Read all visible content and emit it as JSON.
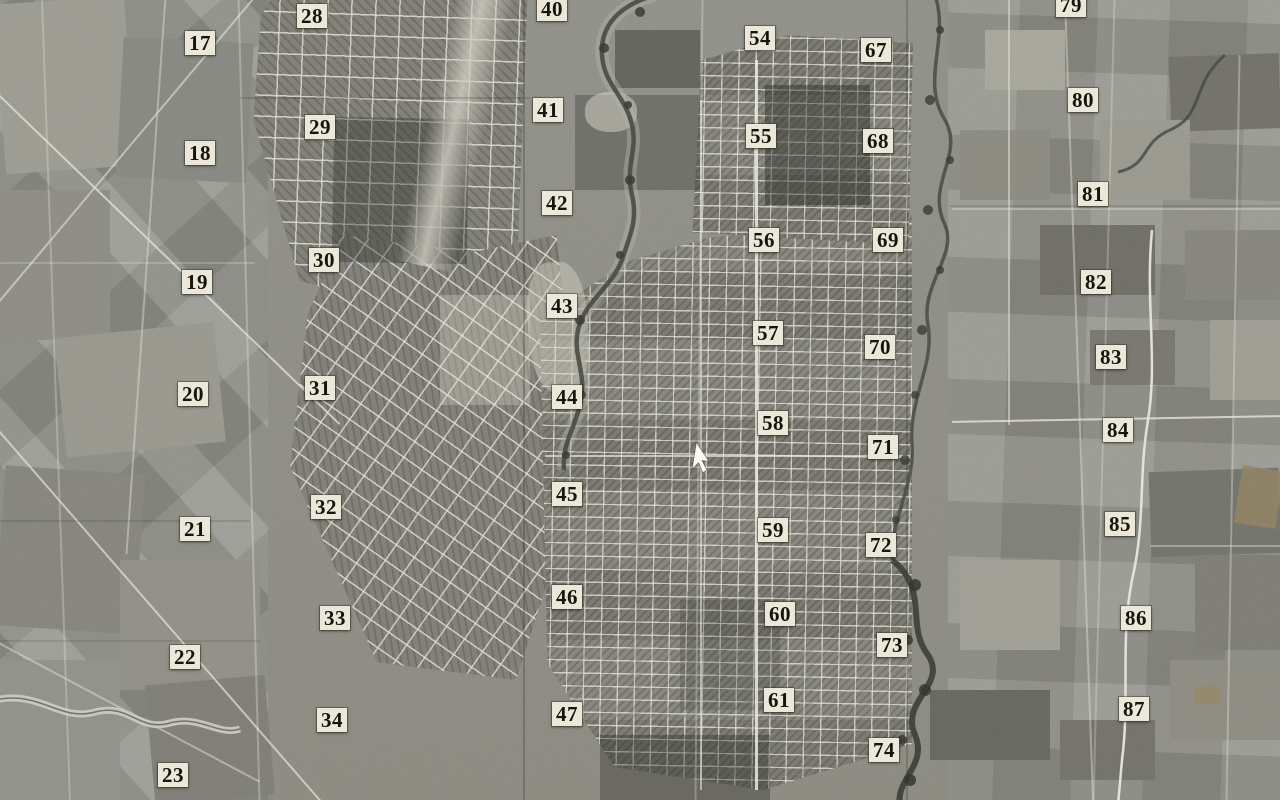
{
  "map": {
    "kind": "aerial-photograph-mosaic-index",
    "description": "Black-and-white aerial survey photo mosaic of a town and surrounding farmland, overlaid with numbered photo-index labels",
    "palette": {
      "photo_base": "#8d8d85",
      "label_bg": "#ece8d9",
      "label_text": "#16140f",
      "river_dark": "#3c3c36",
      "scratch_white": "#eceadf"
    },
    "photo_labels": [
      {
        "num": "17",
        "x": 200,
        "y": 43
      },
      {
        "num": "18",
        "x": 200,
        "y": 153
      },
      {
        "num": "19",
        "x": 197,
        "y": 282
      },
      {
        "num": "20",
        "x": 193,
        "y": 394
      },
      {
        "num": "21",
        "x": 195,
        "y": 529
      },
      {
        "num": "22",
        "x": 185,
        "y": 657
      },
      {
        "num": "23",
        "x": 173,
        "y": 775
      },
      {
        "num": "28",
        "x": 312,
        "y": 16
      },
      {
        "num": "29",
        "x": 320,
        "y": 127
      },
      {
        "num": "30",
        "x": 324,
        "y": 260
      },
      {
        "num": "31",
        "x": 320,
        "y": 388
      },
      {
        "num": "32",
        "x": 326,
        "y": 507
      },
      {
        "num": "33",
        "x": 335,
        "y": 618
      },
      {
        "num": "34",
        "x": 332,
        "y": 720
      },
      {
        "num": "40",
        "x": 552,
        "y": 9
      },
      {
        "num": "41",
        "x": 548,
        "y": 110
      },
      {
        "num": "42",
        "x": 557,
        "y": 203
      },
      {
        "num": "43",
        "x": 562,
        "y": 306
      },
      {
        "num": "44",
        "x": 567,
        "y": 397
      },
      {
        "num": "45",
        "x": 567,
        "y": 494
      },
      {
        "num": "46",
        "x": 567,
        "y": 597
      },
      {
        "num": "47",
        "x": 567,
        "y": 714
      },
      {
        "num": "54",
        "x": 760,
        "y": 38
      },
      {
        "num": "55",
        "x": 761,
        "y": 136
      },
      {
        "num": "56",
        "x": 764,
        "y": 240
      },
      {
        "num": "57",
        "x": 768,
        "y": 333
      },
      {
        "num": "58",
        "x": 773,
        "y": 423
      },
      {
        "num": "59",
        "x": 773,
        "y": 530
      },
      {
        "num": "60",
        "x": 780,
        "y": 614
      },
      {
        "num": "61",
        "x": 779,
        "y": 700
      },
      {
        "num": "67",
        "x": 876,
        "y": 50
      },
      {
        "num": "68",
        "x": 878,
        "y": 141
      },
      {
        "num": "69",
        "x": 888,
        "y": 240
      },
      {
        "num": "70",
        "x": 880,
        "y": 347
      },
      {
        "num": "71",
        "x": 883,
        "y": 447
      },
      {
        "num": "72",
        "x": 881,
        "y": 545
      },
      {
        "num": "73",
        "x": 892,
        "y": 645
      },
      {
        "num": "74",
        "x": 884,
        "y": 750
      },
      {
        "num": "79",
        "x": 1071,
        "y": 5
      },
      {
        "num": "80",
        "x": 1083,
        "y": 100
      },
      {
        "num": "81",
        "x": 1093,
        "y": 194
      },
      {
        "num": "82",
        "x": 1096,
        "y": 282
      },
      {
        "num": "83",
        "x": 1111,
        "y": 357
      },
      {
        "num": "84",
        "x": 1118,
        "y": 430
      },
      {
        "num": "85",
        "x": 1120,
        "y": 524
      },
      {
        "num": "86",
        "x": 1136,
        "y": 618
      },
      {
        "num": "87",
        "x": 1134,
        "y": 709
      }
    ],
    "cursor": {
      "name": "mouse-pointer",
      "x": 688,
      "y": 441
    }
  }
}
